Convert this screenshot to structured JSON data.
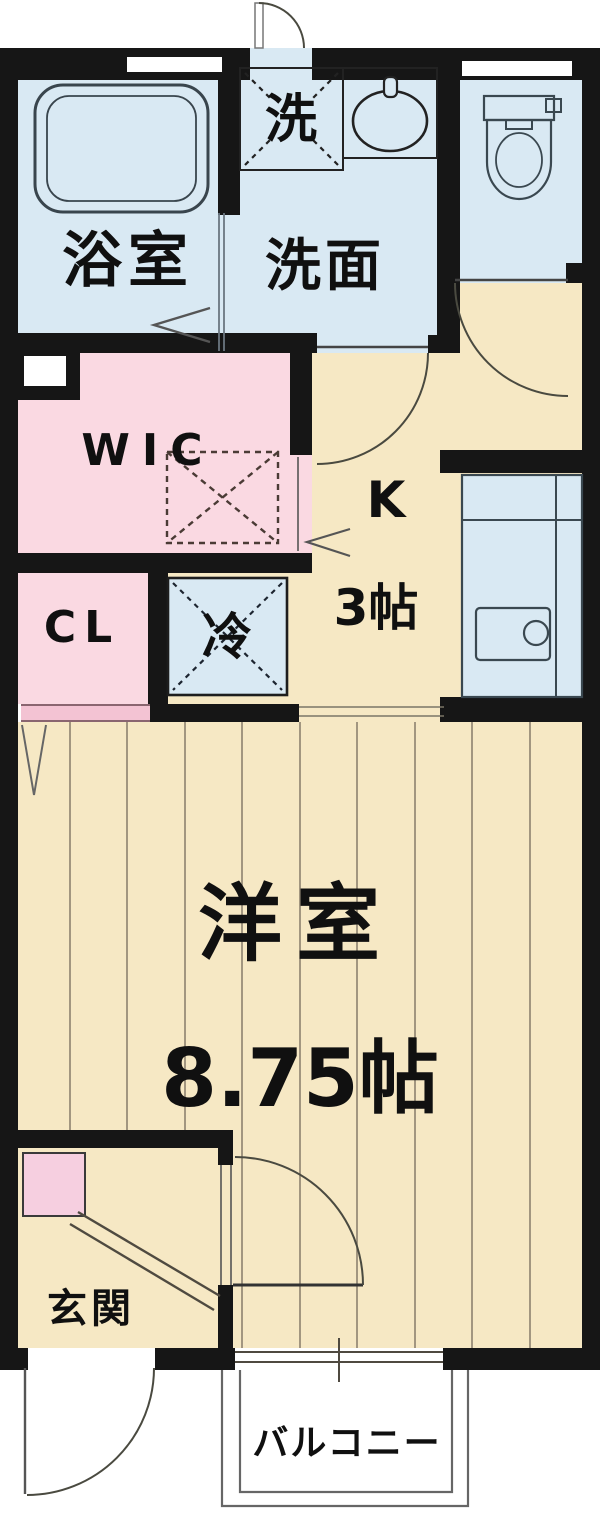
{
  "floorplan": {
    "rooms": {
      "bathroom": {
        "label": "浴室"
      },
      "laundry_pan": {
        "label": "洗"
      },
      "washroom": {
        "label": "洗面"
      },
      "wic": {
        "label": "WIC"
      },
      "closet": {
        "label": "CL"
      },
      "fridge_space": {
        "label": "冷"
      },
      "kitchen": {
        "label": "K",
        "size": "3帖"
      },
      "western_room": {
        "label": "洋室",
        "size": "8.75帖"
      },
      "entrance": {
        "label": "玄関"
      },
      "balcony": {
        "label": "バルコニー"
      }
    },
    "colors": {
      "wall": "#161616",
      "water_blue": "#d9e9f3",
      "floor_cream": "#f6e8c4",
      "closet_pink": "#fad9e2",
      "accent_pink": "#f6cfe0",
      "cl_door_pink": "#f3c3d3",
      "outline": "#4a4a40",
      "floor_line": "#8d8270"
    }
  }
}
